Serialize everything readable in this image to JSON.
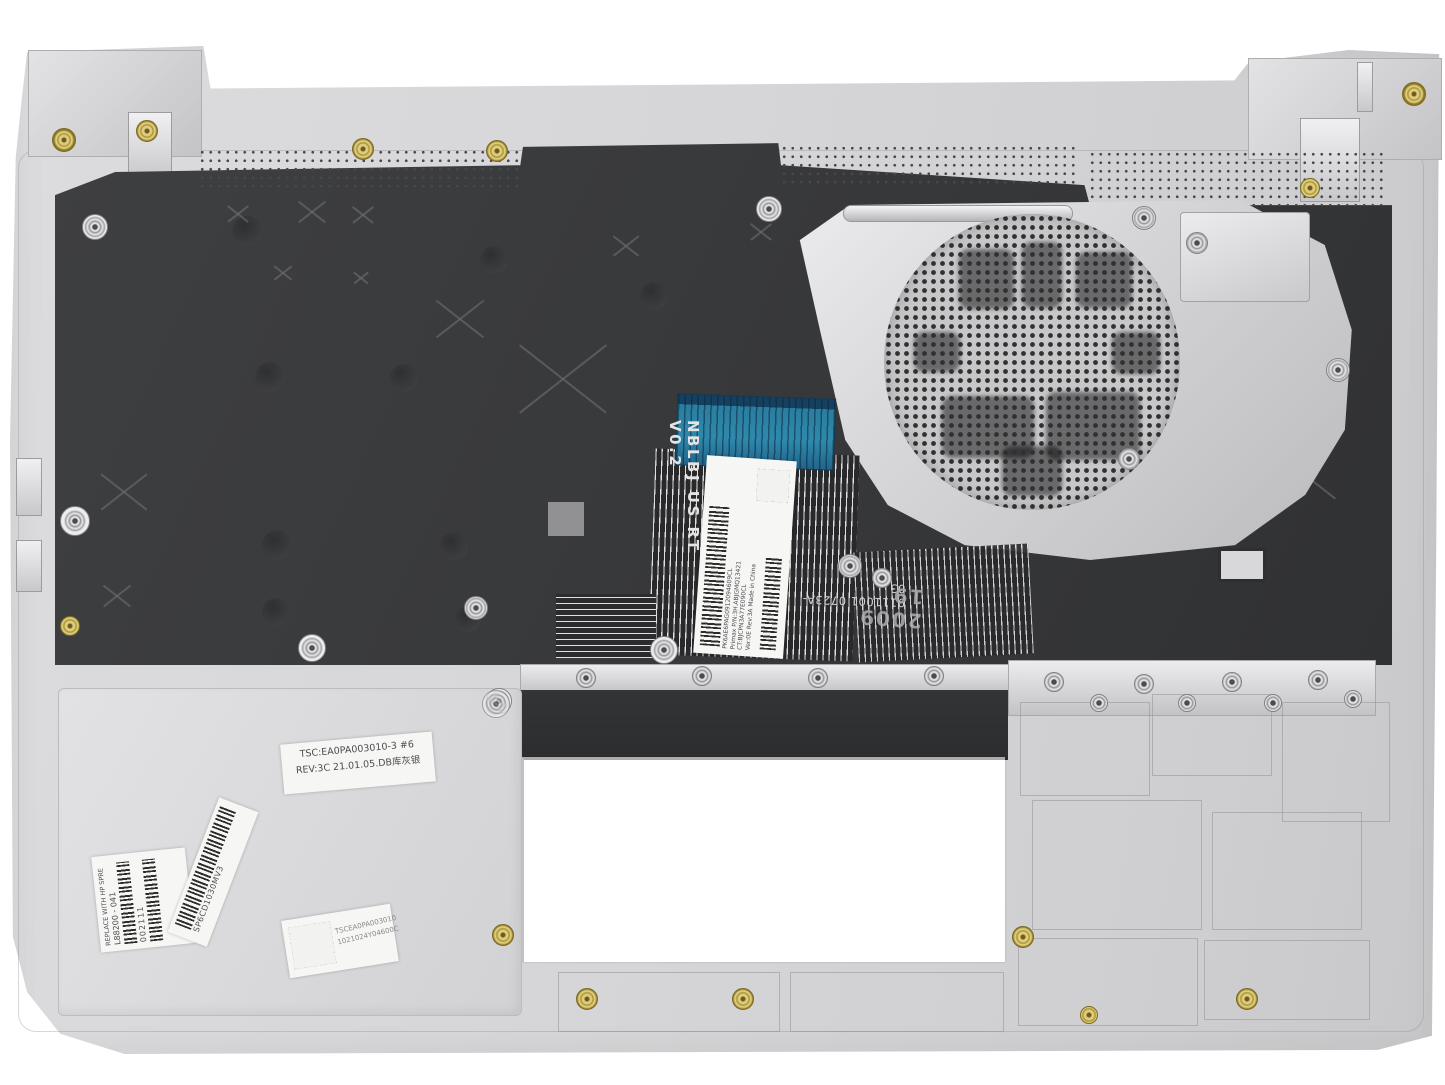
{
  "photo": {
    "subject": "Laptop palmrest keyboard assembly, rear view",
    "colors": {
      "body_silver": "#d6d6d8",
      "backplate_black": "#3a3b3d",
      "flex_blue": "#2a7d9e",
      "brass": "#cdb75a"
    }
  },
  "keyboard_flex": {
    "connector_text": "NBLBJ US RT V0.2",
    "label_line1": "PK6AE6PAG0912094609CL",
    "label_line2": "Primax P/N:3H.ABJGMQ13421",
    "label_line3": "CT:BJCPN3A77E090CL",
    "label_line4": "Ver:0E   Rev:3A   Made in China"
  },
  "backplate_markings": {
    "serial_text": "9111001 0723A-03",
    "date_stamp": "2009 19"
  },
  "labels": {
    "rev_line1": "TSC:EA0PA003010-3 #6",
    "rev_line2": "REV:3C 21.01.05.DB库灰银",
    "hp_title": "REPLACE WITH HP SPRE",
    "hp_part": "L88200 - 041",
    "hp_code": "002111",
    "serial_barcode_text": "SP6CD1030MV3",
    "dm_line1": "TSCEA0PA003010",
    "dm_line2": "1021024Y04600C"
  }
}
